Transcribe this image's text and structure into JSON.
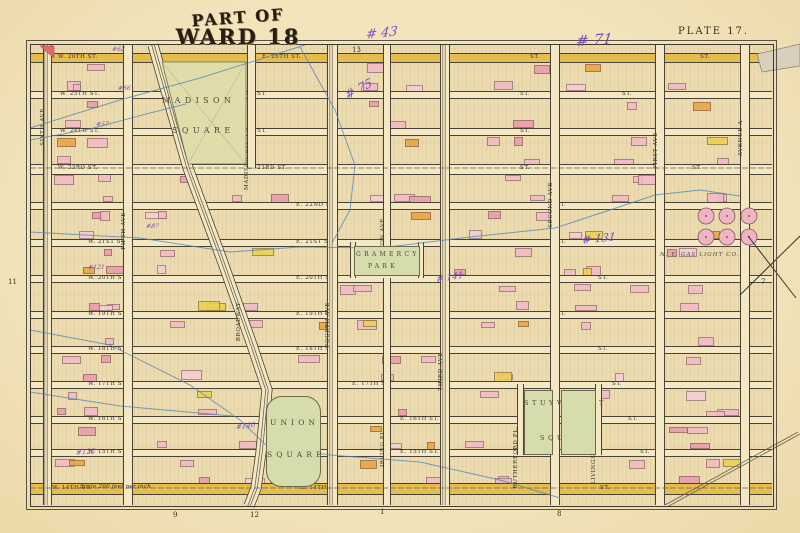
{
  "plate": {
    "title_line1": "PART OF",
    "title_line2": "WARD 18",
    "plate_label": "PLATE 17.",
    "scale_note": "Scale 200 feet per inch"
  },
  "colors": {
    "paper": "#f2e3bd",
    "block": "#ecdcaf",
    "street": "#f4e8c4",
    "highlight_street": "#e5bc4e",
    "park_green": "#d6dcab",
    "building_pink": "#f2b9c8",
    "building_red": "#e99aad",
    "building_orange": "#e8a33c",
    "building_yellow": "#ecd04e",
    "stream_blue": "#4d83b5",
    "handwriting_purple": "#6d3fc2",
    "frame_ink": "#3f392d"
  },
  "edge_refs": {
    "top": [
      {
        "t": "13",
        "x": 352,
        "y": 46
      }
    ],
    "bottom": [
      {
        "t": "9",
        "x": 173,
        "y": 511
      },
      {
        "t": "12",
        "x": 250,
        "y": 511
      },
      {
        "t": "1",
        "x": 380,
        "y": 508
      },
      {
        "t": "8",
        "x": 557,
        "y": 510
      }
    ],
    "left": [
      {
        "t": "11",
        "x": 8,
        "y": 278
      }
    ],
    "right": [
      {
        "t": "7",
        "x": 761,
        "y": 278
      }
    ]
  },
  "streets": [
    {
      "name": "26th St",
      "y": 57,
      "w": 8,
      "hl": true,
      "labels": [
        {
          "x": 58,
          "t": "W. 26TH ST."
        },
        {
          "x": 262,
          "t": "E. 26TH ST."
        },
        {
          "x": 530,
          "t": "ST."
        },
        {
          "x": 700,
          "t": "ST."
        }
      ]
    },
    {
      "name": "25th St",
      "y": 94,
      "w": 6,
      "labels": [
        {
          "x": 60,
          "t": "W. 25TH ST."
        },
        {
          "x": 228,
          "t": "E. 25TH ST."
        },
        {
          "x": 520,
          "t": "ST."
        },
        {
          "x": 622,
          "t": "ST."
        }
      ]
    },
    {
      "name": "24th St",
      "y": 131,
      "w": 6,
      "labels": [
        {
          "x": 60,
          "t": "W. 24TH ST."
        },
        {
          "x": 228,
          "t": "E. 24TH ST."
        },
        {
          "x": 520,
          "t": "ST."
        }
      ]
    },
    {
      "name": "23rd St",
      "y": 168,
      "w": 9,
      "tracks": true,
      "labels": [
        {
          "x": 58,
          "t": "W. 23RD ST."
        },
        {
          "x": 248,
          "t": "E. 23RD ST."
        },
        {
          "x": 520,
          "t": "ST."
        },
        {
          "x": 692,
          "t": "ST."
        }
      ]
    },
    {
      "name": "22nd St",
      "y": 205,
      "w": 6,
      "labels": [
        {
          "x": 296,
          "t": "E. 22ND ST."
        },
        {
          "x": 556,
          "t": "ST."
        }
      ]
    },
    {
      "name": "21st St",
      "y": 242,
      "w": 6,
      "labels": [
        {
          "x": 88,
          "t": "W. 21ST ST."
        },
        {
          "x": 296,
          "t": "E. 21ST ST."
        },
        {
          "x": 556,
          "t": "ST."
        }
      ]
    },
    {
      "name": "20th St",
      "y": 278,
      "w": 6,
      "labels": [
        {
          "x": 88,
          "t": "W. 20TH ST."
        },
        {
          "x": 296,
          "t": "E. 20TH ST."
        },
        {
          "x": 598,
          "t": "ST."
        }
      ]
    },
    {
      "name": "19th St",
      "y": 314,
      "w": 6,
      "labels": [
        {
          "x": 88,
          "t": "W. 19TH ST."
        },
        {
          "x": 296,
          "t": "E. 19TH ST."
        },
        {
          "x": 556,
          "t": "ST."
        }
      ]
    },
    {
      "name": "18th St",
      "y": 349,
      "w": 6,
      "labels": [
        {
          "x": 88,
          "t": "W. 18TH ST."
        },
        {
          "x": 296,
          "t": "E. 18TH ST."
        },
        {
          "x": 598,
          "t": "ST."
        }
      ]
    },
    {
      "name": "17th St",
      "y": 384,
      "w": 6,
      "labels": [
        {
          "x": 88,
          "t": "W. 17TH ST."
        },
        {
          "x": 352,
          "t": "E. 17TH ST."
        },
        {
          "x": 612,
          "t": "ST."
        }
      ]
    },
    {
      "name": "16th St",
      "y": 419,
      "w": 6,
      "labels": [
        {
          "x": 88,
          "t": "W. 16TH ST."
        },
        {
          "x": 400,
          "t": "E. 16TH ST."
        },
        {
          "x": 628,
          "t": "ST."
        }
      ]
    },
    {
      "name": "15th St",
      "y": 452,
      "w": 6,
      "labels": [
        {
          "x": 88,
          "t": "W. 15TH ST."
        },
        {
          "x": 400,
          "t": "E. 15TH ST."
        },
        {
          "x": 640,
          "t": "ST."
        }
      ]
    },
    {
      "name": "14th St",
      "y": 488,
      "w": 10,
      "hl": true,
      "tracks": true,
      "labels": [
        {
          "x": 52,
          "t": "W. 14TH ST."
        },
        {
          "x": 300,
          "t": "E. 14TH ST."
        },
        {
          "x": 600,
          "t": "ST."
        }
      ]
    }
  ],
  "avenues": [
    {
      "name": "SIXTH AVE",
      "x": 46,
      "w": 7,
      "y1": 45,
      "y2": 505,
      "label_y": 108,
      "tracks": true
    },
    {
      "name": "FIFTH AVE",
      "x": 127,
      "w": 8,
      "y1": 45,
      "y2": 505,
      "label_y": 212
    },
    {
      "name": "MADISON AVE",
      "x": 250,
      "w": 7,
      "y1": 45,
      "y2": 168,
      "label_y": 140
    },
    {
      "name": "FOURTH AVE",
      "x": 331,
      "w": 9,
      "y1": 45,
      "y2": 505,
      "label_y": 302,
      "tracks": true
    },
    {
      "name": "LEXINGTON AVE",
      "x": 386,
      "w": 6,
      "y1": 45,
      "y2": 246,
      "label_y": 218
    },
    {
      "name": "GRAMERCY PL.",
      "x": 352,
      "w": 4,
      "y1": 242,
      "y2": 278,
      "label_y": 0
    },
    {
      "name": "GRAMERCY PL.",
      "x": 420,
      "w": 4,
      "y1": 242,
      "y2": 278,
      "label_y": 0
    },
    {
      "name": "IRVING PL.",
      "x": 386,
      "w": 6,
      "y1": 278,
      "y2": 505,
      "label_y": 428
    },
    {
      "name": "THIRD AVE",
      "x": 444,
      "w": 8,
      "y1": 45,
      "y2": 505,
      "label_y": 352,
      "tracks": true
    },
    {
      "name": "RUTHERFORD PL.",
      "x": 519,
      "w": 5,
      "y1": 384,
      "y2": 455,
      "label_y": 426
    },
    {
      "name": "SECOND AVE",
      "x": 554,
      "w": 8,
      "y1": 45,
      "y2": 505,
      "label_y": 182
    },
    {
      "name": "LIVINGSTON PL.",
      "x": 597,
      "w": 5,
      "y1": 384,
      "y2": 455,
      "label_y": 426
    },
    {
      "name": "FIRST AVE",
      "x": 659,
      "w": 8,
      "y1": 45,
      "y2": 505,
      "label_y": 132
    },
    {
      "name": "AVENUE A",
      "x": 744,
      "w": 8,
      "y1": 45,
      "y2": 505,
      "label_y": 120
    }
  ],
  "broadway": {
    "name": "BROADWAY",
    "points": [
      [
        153,
        45
      ],
      [
        172,
        112
      ],
      [
        188,
        168
      ],
      [
        222,
        260
      ],
      [
        252,
        345
      ],
      [
        267,
        390
      ],
      [
        261,
        452
      ],
      [
        256,
        488
      ],
      [
        249,
        506
      ]
    ],
    "label": {
      "x": 236,
      "y": 302,
      "rotate": 72
    }
  },
  "parks": [
    {
      "id": "madison",
      "name_line1": "MADISON",
      "name_line2": "SQUARE",
      "poly": [
        [
          162,
          62
        ],
        [
          246,
          62
        ],
        [
          246,
          164
        ],
        [
          188,
          164
        ]
      ],
      "label1": {
        "x": 162,
        "y": 96,
        "s": 8
      },
      "label2": {
        "x": 172,
        "y": 126,
        "s": 8
      }
    },
    {
      "id": "gramercy",
      "name_line1": "GRAMERCY",
      "name_line2": "PARK",
      "rect": [
        354,
        246,
        64,
        28
      ],
      "label1": {
        "x": 356,
        "y": 251,
        "s": 6
      },
      "label2": {
        "x": 368,
        "y": 263,
        "s": 6
      }
    },
    {
      "id": "union",
      "name_line1": "UNION",
      "name_line2": "SQUARE",
      "rect": [
        266,
        396,
        53,
        89
      ],
      "label1": {
        "x": 270,
        "y": 418,
        "s": 7.5
      },
      "label2": {
        "x": 267,
        "y": 450,
        "s": 7.5
      }
    },
    {
      "id": "stuyvesant_w",
      "name_line1": "STUYVESANT",
      "name_line2": "SQUARE",
      "rect": [
        524,
        390,
        27,
        63
      ],
      "label1": {
        "x": 524,
        "y": 399,
        "s": 6.5
      },
      "label2": {
        "x": 540,
        "y": 434,
        "s": 6.5
      }
    },
    {
      "id": "stuyvesant_e",
      "name_line1": "",
      "name_line2": "",
      "rect": [
        561,
        390,
        33,
        63
      ],
      "label1": null,
      "label2": null
    }
  ],
  "landmarks": [
    {
      "t": "N. Y. GAS LIGHT CO.",
      "x": 660,
      "y": 252,
      "s": 5.5,
      "italic": true
    }
  ],
  "gas_tanks": [
    {
      "cx": 706,
      "cy": 216,
      "r": 8
    },
    {
      "cx": 727,
      "cy": 216,
      "r": 8
    },
    {
      "cx": 749,
      "cy": 216,
      "r": 8
    },
    {
      "cx": 706,
      "cy": 237,
      "r": 8
    },
    {
      "cx": 727,
      "cy": 237,
      "r": 8
    },
    {
      "cx": 749,
      "cy": 237,
      "r": 8
    }
  ],
  "streams": [
    {
      "pts": [
        [
          30,
          128
        ],
        [
          120,
          100
        ],
        [
          200,
          78
        ],
        [
          305,
          45
        ]
      ]
    },
    {
      "pts": [
        [
          30,
          140
        ],
        [
          90,
          129
        ],
        [
          150,
          113
        ],
        [
          186,
          104
        ]
      ]
    },
    {
      "pts": [
        [
          300,
          47
        ],
        [
          335,
          110
        ],
        [
          355,
          165
        ],
        [
          350,
          210
        ],
        [
          332,
          243
        ]
      ]
    },
    {
      "pts": [
        [
          30,
          232
        ],
        [
          140,
          238
        ],
        [
          230,
          252
        ],
        [
          300,
          247
        ],
        [
          380,
          248
        ],
        [
          470,
          237
        ],
        [
          555,
          228
        ],
        [
          610,
          210
        ],
        [
          655,
          195
        ],
        [
          700,
          190
        ],
        [
          740,
          196
        ]
      ]
    },
    {
      "pts": [
        [
          30,
          330
        ],
        [
          110,
          345
        ],
        [
          190,
          385
        ],
        [
          240,
          420
        ],
        [
          266,
          445
        ]
      ]
    },
    {
      "pts": [
        [
          266,
          445
        ],
        [
          330,
          455
        ],
        [
          420,
          462
        ],
        [
          500,
          480
        ],
        [
          560,
          498
        ]
      ]
    },
    {
      "pts": [
        [
          30,
          392
        ],
        [
          120,
          406
        ],
        [
          232,
          416
        ]
      ]
    }
  ],
  "rail_spur": {
    "pts": [
      [
        665,
        505
      ],
      [
        798,
        432
      ]
    ]
  },
  "annotations": [
    {
      "t": "# 43",
      "x": 366,
      "y": 26,
      "s": 13,
      "r": -6
    },
    {
      "t": "# 71",
      "x": 576,
      "y": 31,
      "s": 15,
      "r": -4
    },
    {
      "t": "# 75",
      "x": 344,
      "y": 82,
      "s": 12,
      "r": -28
    },
    {
      "t": "# 131",
      "x": 582,
      "y": 232,
      "s": 11,
      "r": -6
    },
    {
      "t": "# 141",
      "x": 436,
      "y": 273,
      "s": 9,
      "r": -10
    },
    {
      "t": "#62",
      "x": 112,
      "y": 46,
      "s": 6,
      "r": 0
    },
    {
      "t": "#66",
      "x": 118,
      "y": 85,
      "s": 6,
      "r": 0
    },
    {
      "t": "#57",
      "x": 96,
      "y": 121,
      "s": 6,
      "r": 0
    },
    {
      "t": "#87",
      "x": 146,
      "y": 223,
      "s": 6,
      "r": 0
    },
    {
      "t": "#121",
      "x": 88,
      "y": 264,
      "s": 6,
      "r": 0
    },
    {
      "t": "#140",
      "x": 236,
      "y": 422,
      "s": 7,
      "r": -8
    },
    {
      "t": "#122",
      "x": 76,
      "y": 448,
      "s": 7,
      "r": -5
    }
  ]
}
